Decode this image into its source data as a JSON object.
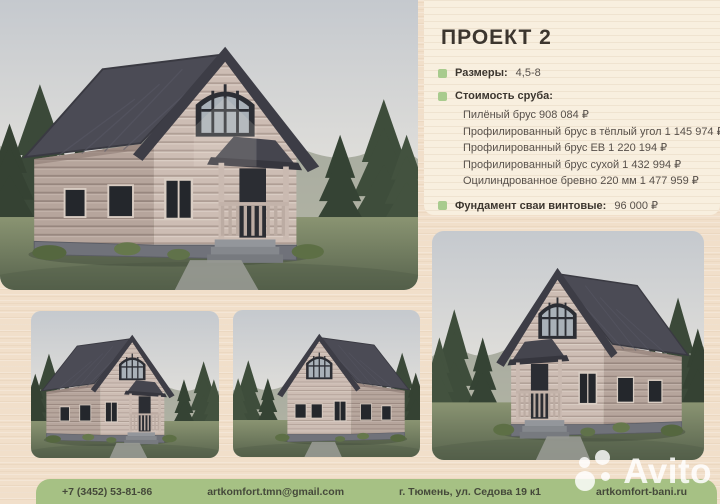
{
  "project": {
    "title": "ПРОЕКТ 2",
    "size_label": "Размеры:",
    "size_value": "4,5-8",
    "cost_label": "Стоимость сруба:",
    "cost_items": [
      "Пилёный брус 908 084 ₽",
      "Профилированный брус в тёплый угол 1 145 974 ₽",
      "Профилированный брус ЕВ 1 220 194 ₽",
      "Профилированный брус сухой 1 432 994 ₽",
      "Оцилиндрованное бревно 220 мм 1 477 959 ₽"
    ],
    "foundation_label": "Фундамент сваи винтовые:",
    "foundation_value": "96 000 ₽"
  },
  "footer": {
    "phone": "+7 (3452) 53-81-86",
    "email": "artkomfort.tmn@gmail.com",
    "address": "г. Тюмень, ул. Седова 19 к1",
    "website": "artkomfort-bani.ru"
  },
  "watermark": {
    "brand": "Avito"
  },
  "icons": {
    "bullet": "green-square-bullet-icon",
    "avito_logo": "avito-dots-icon"
  },
  "colors": {
    "background_cream": "#f1dfca",
    "panel_cream": "#f8efdf",
    "accent_green": "#a6c184",
    "bullet_green": "#a8cb8e",
    "text_dark": "#3c362f",
    "text_body": "#57504a",
    "footer_text": "#45493a",
    "roof_gray": "#4b4b55",
    "log_tan": "#cdbdb4"
  }
}
